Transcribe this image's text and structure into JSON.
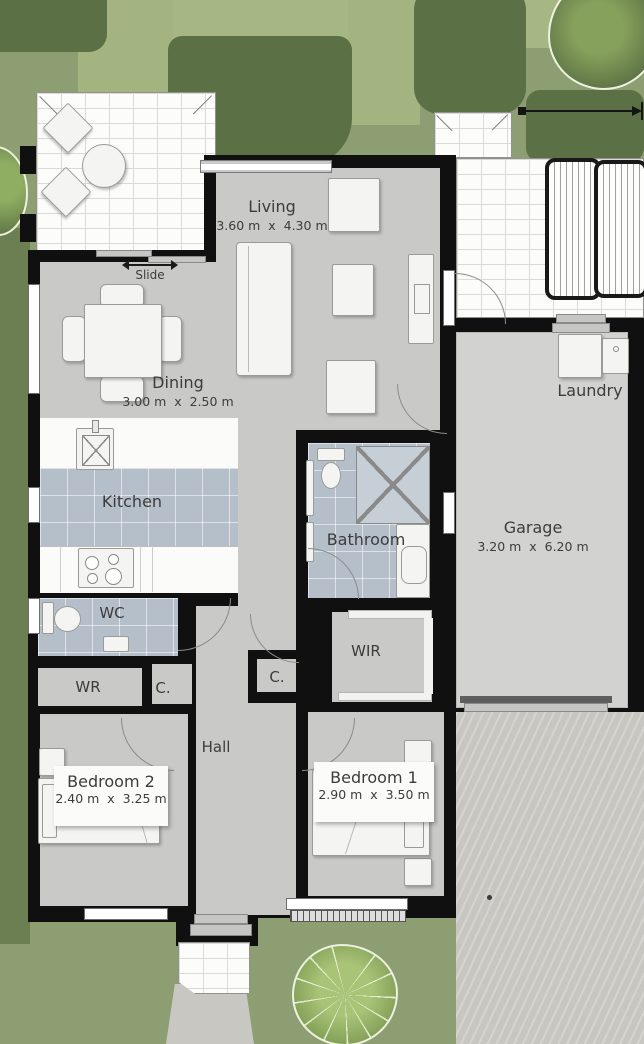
{
  "plan": {
    "rooms": {
      "living": {
        "name": "Living",
        "dims": "3.60 m  x  4.30 m"
      },
      "dining": {
        "name": "Dining",
        "dims": "3.00 m  x  2.50 m"
      },
      "kitchen": {
        "name": "Kitchen"
      },
      "bathroom": {
        "name": "Bathroom"
      },
      "laundry": {
        "name": "Laundry"
      },
      "garage": {
        "name": "Garage",
        "dims": "3.20 m  x  6.20 m"
      },
      "wc": {
        "name": "WC"
      },
      "wr": {
        "name": "WR"
      },
      "wir": {
        "name": "WIR"
      },
      "cupboard_a": {
        "name": "C."
      },
      "cupboard_b": {
        "name": "C."
      },
      "hall": {
        "name": "Hall"
      },
      "bedroom1": {
        "name": "Bedroom 1",
        "dims": "2.90 m  x  3.50 m"
      },
      "bedroom2": {
        "name": "Bedroom 2",
        "dims": "2.40 m  x  3.25 m"
      }
    },
    "annotations": {
      "sliding_door": "Slide"
    },
    "colors": {
      "wall": "#101010",
      "floor": "#c9cac8",
      "tile": "#b5bfc9",
      "grass": "#8d9e72",
      "hedge": "#5c7046",
      "paving": "#fcfcfa",
      "driveway": "#c8c6c1"
    }
  }
}
